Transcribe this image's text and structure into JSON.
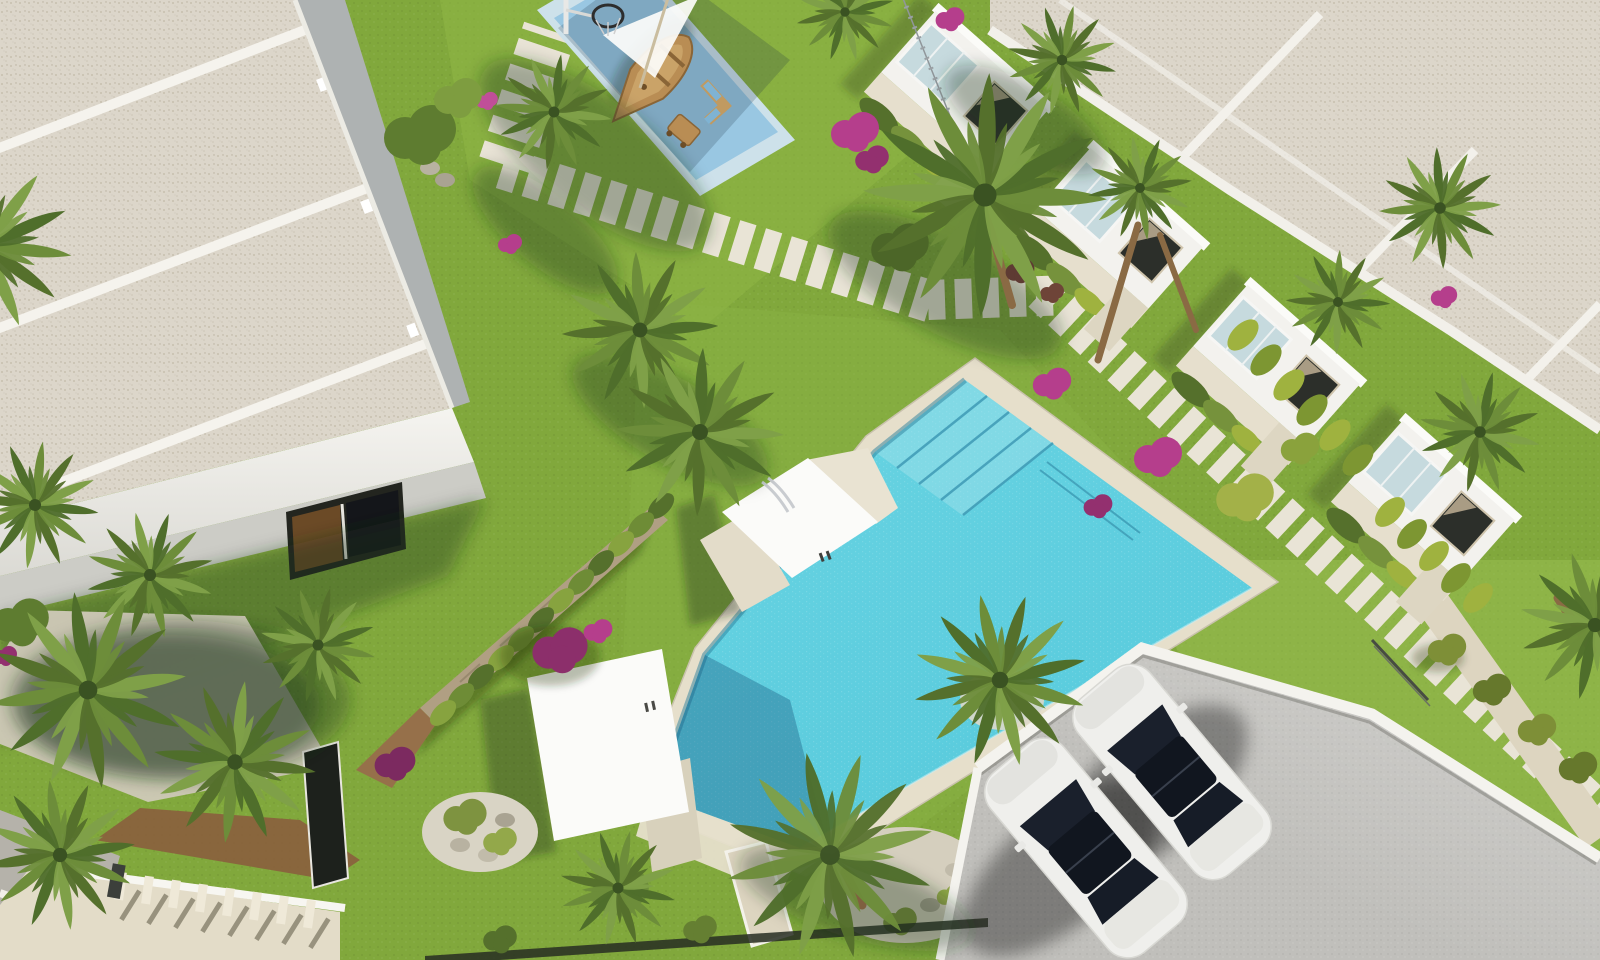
{
  "scene": {
    "type": "aerial-3d-architectural-render",
    "description": "Bird's-eye render of a residential complex: apartment block with gravel flat roofs, row of white townhouses, L-shaped turquoise pool with entry steps, children's splash pad with wooden boat playground and basketball hoop, landscaped gardens with palms and pink bougainvillea, stepping-stone paths, and a parking area with two white cars",
    "time_of_day": "sunny daytime, light from upper right"
  },
  "colors": {
    "grass": "#81a83c",
    "grass_light": "#8fb646",
    "grass_lime": "#9ec455",
    "pool_water": "#5fd0e0",
    "pool_step_line": "#3f9ab5",
    "pool_coping": "#e6dfcb",
    "pad_outer": "#cde1ea",
    "pad_inner": "#99c7e2",
    "roof_speckle": "#dcd6ca",
    "wall_white": "#f3f2ee",
    "window_dark": "#2c2f2a",
    "window_tan": "#b7a98e",
    "parking": "#c0bfbb",
    "curb": "#f4f3ee",
    "car_body": "#efefec",
    "car_glass": "#1a202c",
    "path_slat": "#e9e4d6",
    "walkway": "#ddd5c0",
    "stone_wall": "#b09f83",
    "gravel": "#d5cfbe",
    "mulch": "#8a5e3d",
    "hedge_dark": "#55702c",
    "hedge_bright": "#9fb23f",
    "palm_green": "#6d8d3a",
    "flower_pink": "#b53e8c",
    "flower_magenta": "#8c2f6b",
    "wood_boat": "#b98d54",
    "fence_dark": "#272d22",
    "stairs_concrete": "#e3dcc8"
  },
  "objects": {
    "left_building": "apartment block with three speckled gravel roof bays and white parapets",
    "townhouses_visible_units": 4,
    "main_pool": "L-shaped pool with 4 entry steps at top section",
    "kids_splash_pad": "two-tone blue pad with wooden boat playground, shade sail, basketball hoop, toy cart and bench",
    "pergola_decks": 2,
    "parked_cars": 2,
    "palm_trees_approx": 21,
    "stepping_stone_paths": 5,
    "stone_wall_with_cypress_hedge": 1,
    "parking_lot": "grey paved lot with white kerb, lower right",
    "staircase_walkway": "beige ramp with white balustrade posts, lower left"
  }
}
